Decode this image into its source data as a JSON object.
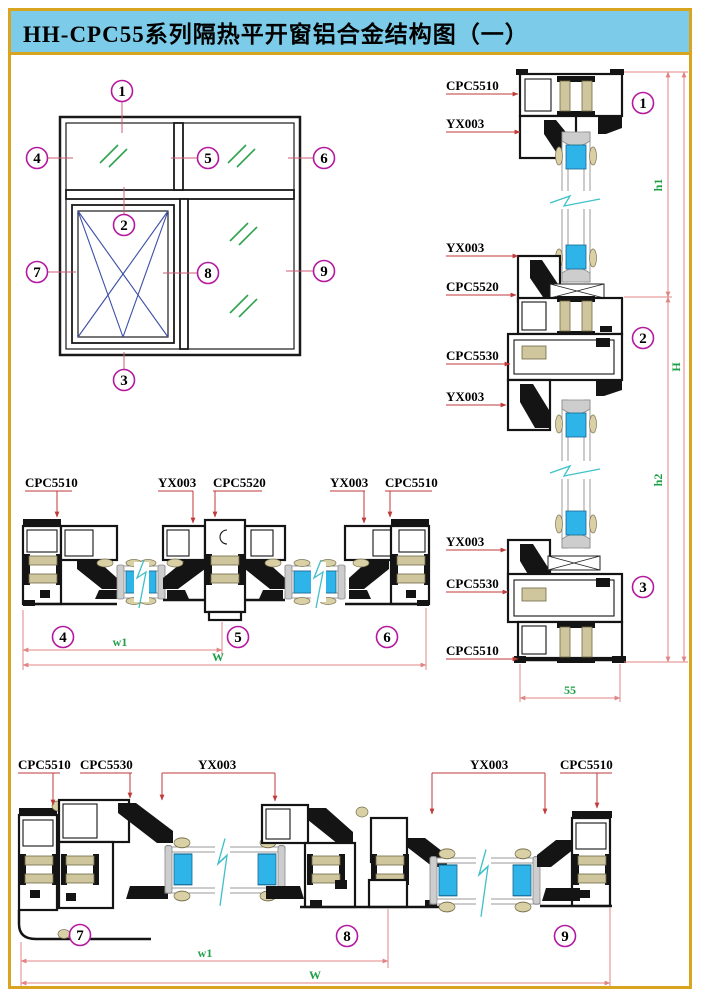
{
  "title": "HH-CPC55系列隔热平开窗铝合金结构图（一）",
  "colors": {
    "page_border": "#D9A520",
    "title_background": "#7CCBE8",
    "callout_magenta": "#B5179E",
    "dimension_green": "#1FA048",
    "leader_red": "#C03A3A",
    "dimension_pink": "#E08585",
    "glass_cyan": "#2FB4E9",
    "thermal_break_tan": "#CFC69E",
    "glass_mark_green": "#2EA44E",
    "casement_blue": "#3D4FA6",
    "break_symbol_teal": "#3FC1C9"
  },
  "elevation": {
    "callouts": [
      "1",
      "2",
      "3",
      "4",
      "5",
      "6",
      "7",
      "8",
      "9"
    ]
  },
  "vertical_section": {
    "labels": [
      "CPC5510",
      "YX003",
      "YX003",
      "CPC5520",
      "CPC5530",
      "YX003",
      "YX003",
      "CPC5530",
      "CPC5510"
    ],
    "callouts": [
      "1",
      "2",
      "3"
    ],
    "dims": {
      "h1": "h1",
      "h2": "h2",
      "H": "H",
      "frame_depth": "55"
    }
  },
  "middle_section": {
    "labels": [
      "CPC5510",
      "YX003",
      "CPC5520",
      "YX003",
      "CPC5510"
    ],
    "callouts": [
      "4",
      "5",
      "6"
    ],
    "dims": {
      "w1": "w1",
      "W": "W"
    }
  },
  "bottom_section": {
    "labels": [
      "CPC5510",
      "CPC5530",
      "YX003",
      "YX003",
      "CPC5510"
    ],
    "callouts": [
      "7",
      "8",
      "9"
    ],
    "dims": {
      "w1": "w1",
      "W": "W"
    }
  }
}
